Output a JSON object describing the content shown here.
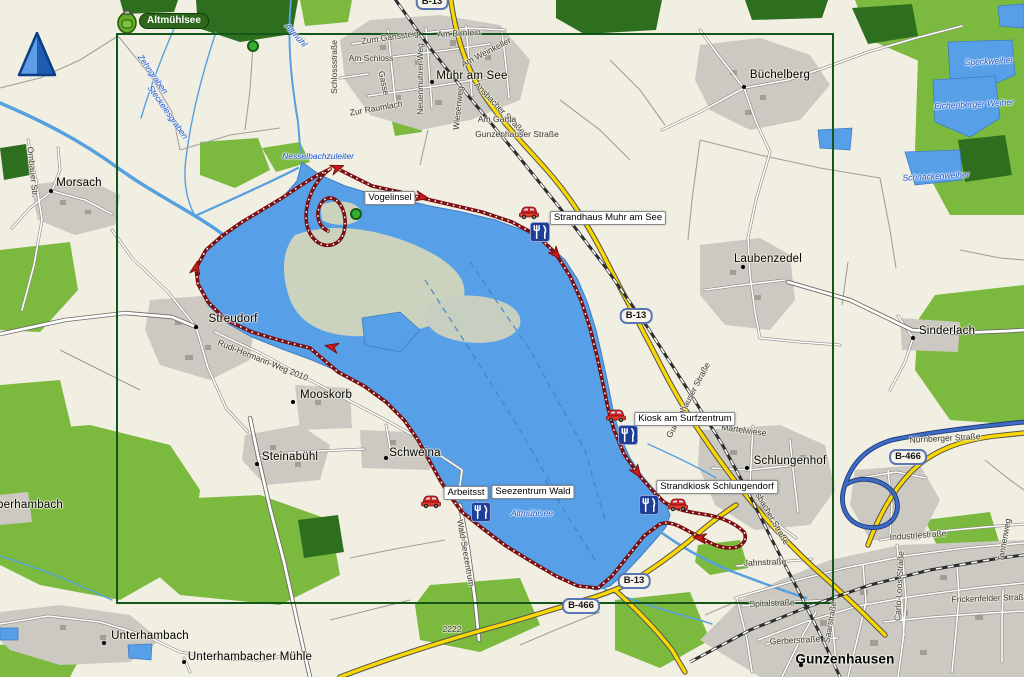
{
  "overlay": {
    "waypoint_badge_label": "Altmühlsee"
  },
  "colors": {
    "background": "#f1efe2",
    "lake": "#57a0e8",
    "forest": "#7cba3f",
    "forest_dark": "#2d6e1f",
    "urban": "#cbc9c1",
    "road_primary_yellow": "#f9d802",
    "road_expressway_blue": "#3d6bc6",
    "track_red": "#7a1012",
    "selection_green": "#14551a"
  },
  "shields": [
    {
      "text": "B-13",
      "x": 432,
      "y": 2
    },
    {
      "text": "B-13",
      "x": 636,
      "y": 316
    },
    {
      "text": "B-13",
      "x": 634,
      "y": 581
    },
    {
      "text": "B-466",
      "x": 908,
      "y": 457
    },
    {
      "text": "B-466",
      "x": 581,
      "y": 606
    }
  ],
  "towns": [
    {
      "text": "Muhr am See",
      "x": 472,
      "y": 76,
      "dot": {
        "x": 432,
        "y": 82
      }
    },
    {
      "text": "Büchelberg",
      "x": 780,
      "y": 75,
      "dot": {
        "x": 744,
        "y": 87
      }
    },
    {
      "text": "Morsach",
      "x": 79,
      "y": 183,
      "dot": {
        "x": 51,
        "y": 191
      }
    },
    {
      "text": "Laubenzedel",
      "x": 768,
      "y": 259,
      "dot": {
        "x": 743,
        "y": 267
      }
    },
    {
      "text": "Streudorf",
      "x": 233,
      "y": 319,
      "dot": {
        "x": 196,
        "y": 327
      }
    },
    {
      "text": "Sinderlach",
      "x": 947,
      "y": 331,
      "dot": {
        "x": 913,
        "y": 338
      }
    },
    {
      "text": "Mooskorb",
      "x": 326,
      "y": 395,
      "dot": {
        "x": 293,
        "y": 402
      }
    },
    {
      "text": "Steinabühl",
      "x": 290,
      "y": 457,
      "dot": {
        "x": 257,
        "y": 464
      }
    },
    {
      "text": "Schweina",
      "x": 415,
      "y": 453,
      "dot": {
        "x": 386,
        "y": 458
      }
    },
    {
      "text": "Schlungenhof",
      "x": 790,
      "y": 461,
      "dot": {
        "x": 747,
        "y": 468
      }
    },
    {
      "text": "berhambach",
      "x": 30,
      "y": 505,
      "dot": null
    },
    {
      "text": "Unterhambach",
      "x": 150,
      "y": 636,
      "dot": {
        "x": 104,
        "y": 643
      }
    },
    {
      "text": "Unterhambacher Mühle",
      "x": 250,
      "y": 657,
      "dot": {
        "x": 184,
        "y": 662
      }
    },
    {
      "text": "Gunzenhausen",
      "x": 845,
      "y": 659,
      "dot": {
        "x": 801,
        "y": 665
      },
      "big": true
    }
  ],
  "streets": [
    {
      "text": "Zum Gänssteig",
      "x": 390,
      "y": 37,
      "rot": -8
    },
    {
      "text": "Am Birnlein",
      "x": 459,
      "y": 33,
      "rot": -3
    },
    {
      "text": "Am Weinkeller",
      "x": 486,
      "y": 52,
      "rot": -27
    },
    {
      "text": "Am Schloss",
      "x": 371,
      "y": 58,
      "rot": 0
    },
    {
      "text": "Gasse",
      "x": 384,
      "y": 83,
      "rot": 78
    },
    {
      "text": "Neuenmuhrer Weg",
      "x": 420,
      "y": 79,
      "rot": -90
    },
    {
      "text": "Schlossstraße",
      "x": 334,
      "y": 67,
      "rot": -90
    },
    {
      "text": "Zur Raumlach",
      "x": 376,
      "y": 108,
      "rot": -10
    },
    {
      "text": "Wiesenweg",
      "x": 458,
      "y": 108,
      "rot": -84
    },
    {
      "text": "Ansbacher Straße",
      "x": 500,
      "y": 108,
      "rot": 46
    },
    {
      "text": "Am Gartla",
      "x": 497,
      "y": 119,
      "rot": 0
    },
    {
      "text": "Gunzenhauser Straße",
      "x": 517,
      "y": 134,
      "rot": 0
    },
    {
      "text": "Ornbauer Str.",
      "x": 33,
      "y": 172,
      "rot": 84
    },
    {
      "text": "Rudi-Hermann-Weg 2010",
      "x": 263,
      "y": 360,
      "rot": 22
    },
    {
      "text": "Gunzenhäuser Straße",
      "x": 688,
      "y": 400,
      "rot": -62
    },
    {
      "text": "Märtelwiese",
      "x": 744,
      "y": 430,
      "rot": 8
    },
    {
      "text": "Ansbacher Straße",
      "x": 770,
      "y": 514,
      "rot": 60
    },
    {
      "text": "Wald-Seezentrum",
      "x": 466,
      "y": 553,
      "rot": 80
    },
    {
      "text": "Nürnberger Straße",
      "x": 945,
      "y": 438,
      "rot": -3
    },
    {
      "text": "Industriestraße",
      "x": 918,
      "y": 535,
      "rot": -4
    },
    {
      "text": "Carlo-Loos-Straße",
      "x": 899,
      "y": 586,
      "rot": -87
    },
    {
      "text": "Frickenfelder Straße",
      "x": 990,
      "y": 598,
      "rot": -2
    },
    {
      "text": "Tannenweg",
      "x": 1004,
      "y": 540,
      "rot": -80
    },
    {
      "text": "Jahnstraße",
      "x": 765,
      "y": 562,
      "rot": -2
    },
    {
      "text": "Spitalstraße",
      "x": 772,
      "y": 603,
      "rot": -2
    },
    {
      "text": "Gerberstraße",
      "x": 795,
      "y": 640,
      "rot": -3
    },
    {
      "text": "Saarstraße",
      "x": 830,
      "y": 622,
      "rot": -80
    },
    {
      "text": "2222",
      "x": 452,
      "y": 629,
      "rot": 0
    }
  ],
  "water_labels": [
    {
      "text": "Altmühl",
      "x": 296,
      "y": 35,
      "rot": 48
    },
    {
      "text": "Zehngraben",
      "x": 153,
      "y": 74,
      "rot": 55
    },
    {
      "text": "Steckelesgraben",
      "x": 168,
      "y": 112,
      "rot": 55
    },
    {
      "text": "Nesselbachzuleiter",
      "x": 318,
      "y": 156,
      "rot": 0
    },
    {
      "text": "Altmühlsee",
      "x": 532,
      "y": 513,
      "rot": 0
    },
    {
      "text": "Speckweiher",
      "x": 989,
      "y": 61,
      "rot": -3
    },
    {
      "text": "Eichenberger Weiher",
      "x": 974,
      "y": 104,
      "rot": -3
    },
    {
      "text": "Schnackenweiher",
      "x": 936,
      "y": 176,
      "rot": -3
    }
  ],
  "boxed_labels": [
    {
      "text": "Arbeitsst",
      "x": 466,
      "y": 493,
      "behind": true
    },
    {
      "text": "Vogelinsel",
      "x": 390,
      "y": 198
    },
    {
      "text": "Seezentrum Wald",
      "x": 533,
      "y": 492
    },
    {
      "text": "Strandhaus Muhr am See",
      "x": 608,
      "y": 218
    },
    {
      "text": "Kiosk am Surfzentrum",
      "x": 685,
      "y": 419
    },
    {
      "text": "Strandkiosk Schlungendorf",
      "x": 717,
      "y": 487
    }
  ],
  "poi_icons": [
    {
      "type": "car",
      "x": 529,
      "y": 212
    },
    {
      "type": "restaurant",
      "x": 540,
      "y": 232
    },
    {
      "type": "car",
      "x": 616,
      "y": 415
    },
    {
      "type": "restaurant",
      "x": 628,
      "y": 435
    },
    {
      "type": "restaurant",
      "x": 649,
      "y": 505
    },
    {
      "type": "car",
      "x": 678,
      "y": 504
    },
    {
      "type": "car",
      "x": 431,
      "y": 501
    },
    {
      "type": "restaurant",
      "x": 481,
      "y": 512
    }
  ],
  "waypoint_dots": [
    {
      "x": 253,
      "y": 46
    },
    {
      "x": 356,
      "y": 214
    }
  ]
}
